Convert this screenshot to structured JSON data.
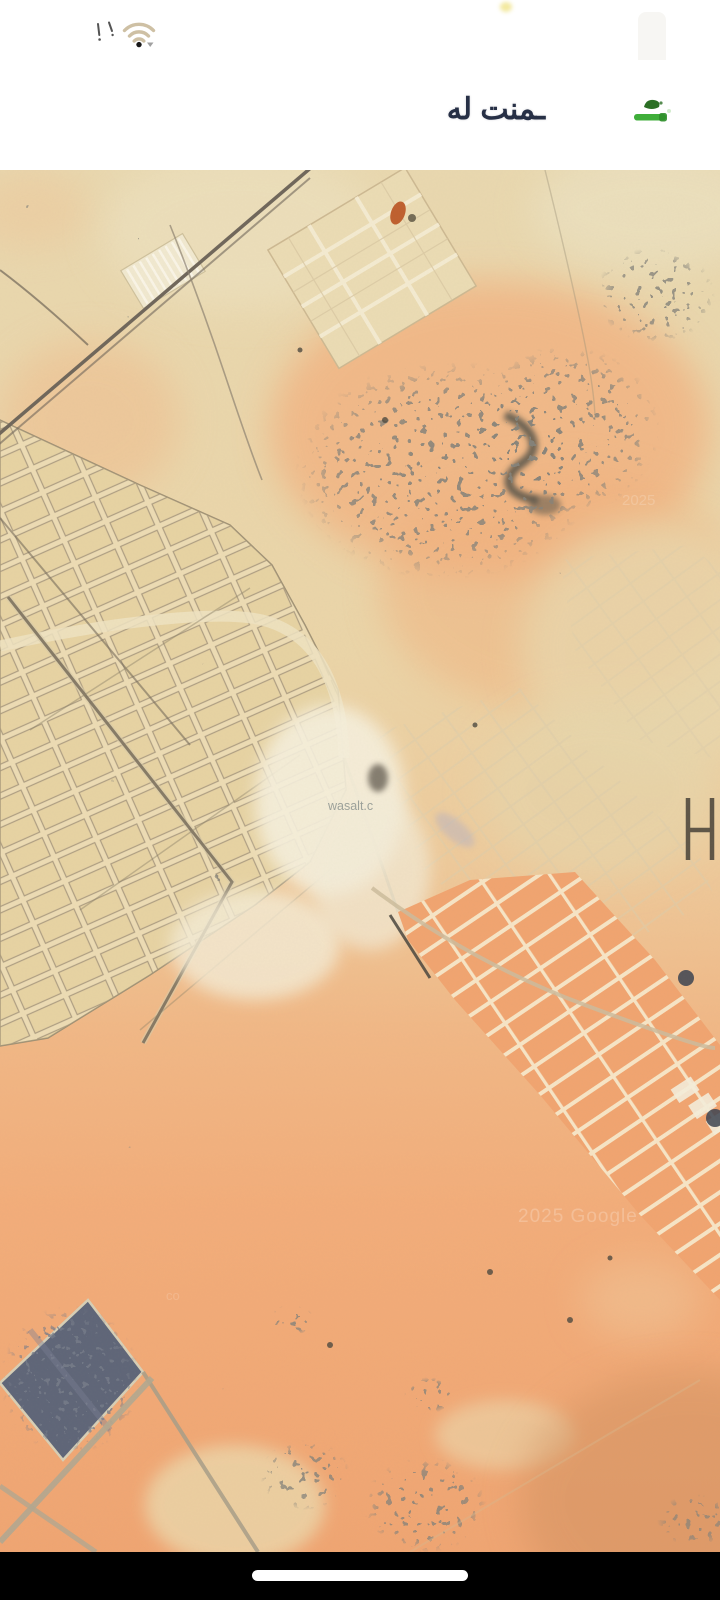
{
  "status_bar": {
    "wifi_icon": "wifi",
    "wifi_color": "#cec0a4"
  },
  "header": {
    "title": "ـمنت له",
    "title_color": "#273046",
    "accent_green": "#3fae3a"
  },
  "map": {
    "watermarks": {
      "provider": "wasalt.c",
      "copyright": "2025 Google",
      "copyright_faint": "2025",
      "partial": "co"
    },
    "palette": {
      "sand_light": "#e9d8af",
      "sand_orange": "#f2ae7c",
      "road_dark": "#6f665a",
      "vegetation_dark": "#3b3932",
      "farm_plot_blue": "#5e6578"
    }
  },
  "system_nav": {
    "bar_color": "#000000",
    "home_indicator_color": "#ffffff"
  }
}
